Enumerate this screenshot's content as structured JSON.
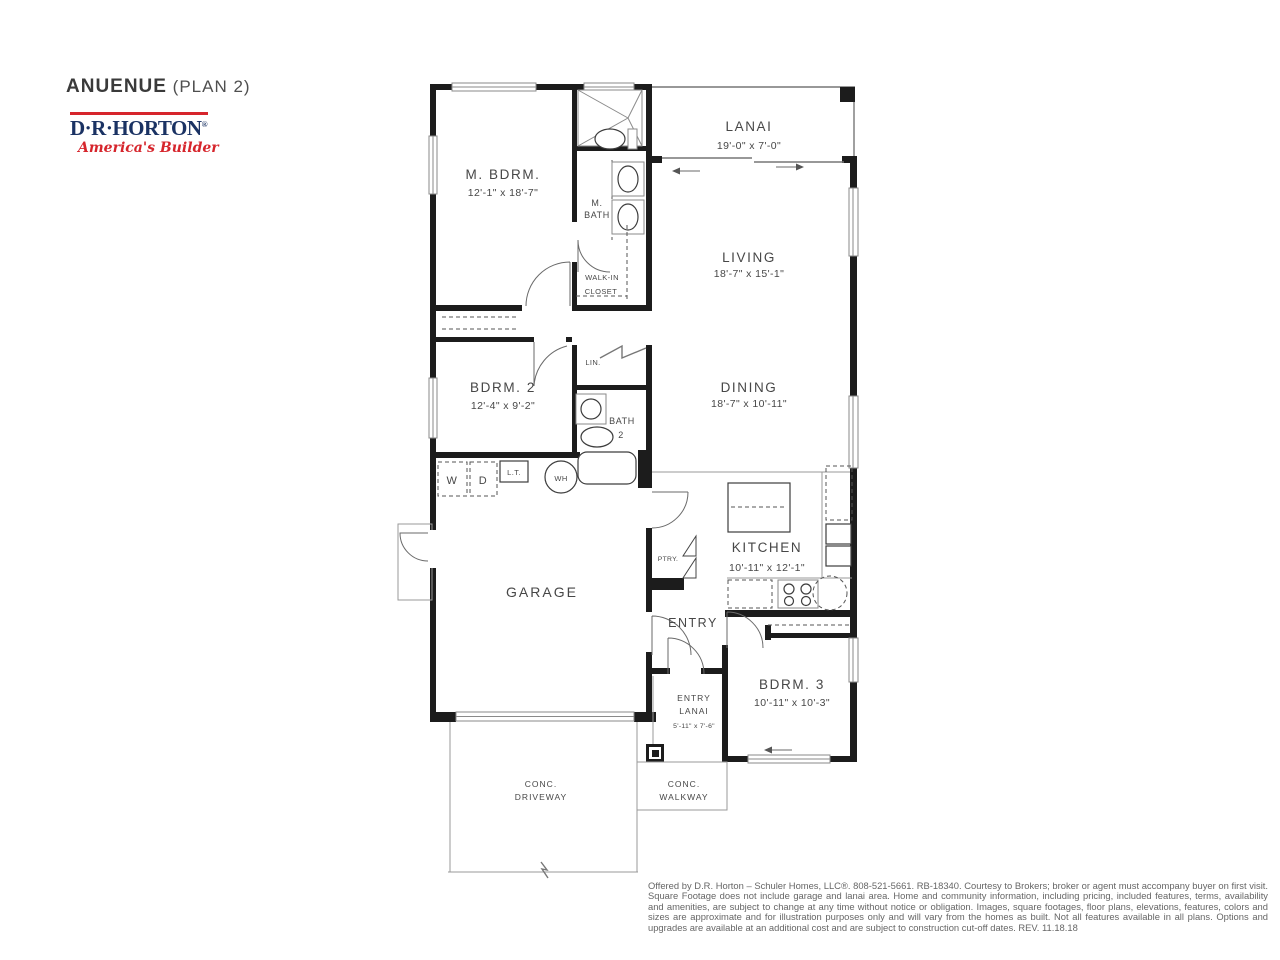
{
  "header": {
    "title": "ANUENUE",
    "subtitle": " (PLAN 2)"
  },
  "logo": {
    "brand": "D·R·HORTON",
    "reg": "®",
    "tagline": "America's Builder"
  },
  "colors": {
    "brand_navy": "#1a3263",
    "brand_red": "#d6252c",
    "wall": "#1c1c1c",
    "label_text": "#474747"
  },
  "rooms": {
    "m_bdrm": {
      "name": "M. BDRM.",
      "dims": "12'-1\" x 18'-7\""
    },
    "lanai": {
      "name": "LANAI",
      "dims": "19'-0\" x 7'-0\""
    },
    "living": {
      "name": "LIVING",
      "dims": "18'-7\" x 15'-1\""
    },
    "dining": {
      "name": "DINING",
      "dims": "18'-7\" x 10'-11\""
    },
    "bdrm2": {
      "name": "BDRM. 2",
      "dims": "12'-4\" x 9'-2\""
    },
    "kitchen": {
      "name": "KITCHEN",
      "dims": "10'-11\" x 12'-1\""
    },
    "garage": {
      "name": "GARAGE"
    },
    "entry": {
      "name": "ENTRY"
    },
    "bdrm3": {
      "name": "BDRM. 3",
      "dims": "10'-11\" x 10'-3\""
    },
    "entry_lanai": {
      "line1": "ENTRY",
      "line2": "LANAI",
      "dims": "5'-11\" x 7'-6\""
    },
    "m_bath": {
      "line1": "M.",
      "line2": "BATH"
    },
    "walkin_closet": {
      "line1": "WALK-IN",
      "line2": "CLOSET"
    },
    "bath2": {
      "line1": "BATH",
      "line2": "2"
    },
    "lin": {
      "name": "LIN."
    }
  },
  "fixtures": {
    "washer": "W",
    "dryer": "D",
    "laundry_tub": "L.T.",
    "water_heater": "WH",
    "pantry": "PTRY."
  },
  "site": {
    "driveway_line1": "CONC.",
    "driveway_line2": "DRIVEWAY",
    "walkway_line1": "CONC.",
    "walkway_line2": "WALKWAY"
  },
  "disclaimer": "Offered by D.R. Horton – Schuler Homes, LLC®. 808-521-5661. RB-18340. Courtesy to Brokers; broker or agent must accompany buyer on first visit. Square Footage does not include garage and lanai area. Home and community information, including pricing, included features, terms, availability and amenities, are subject to change at any time without notice or obligation. Images, square footages, floor plans, elevations, features, colors and sizes are approximate and for illustration purposes only and will vary from the homes as built. Not all features available in all plans. Options and upgrades are available at an additional cost and are subject to construction cut-off dates. REV. 11.18.18"
}
